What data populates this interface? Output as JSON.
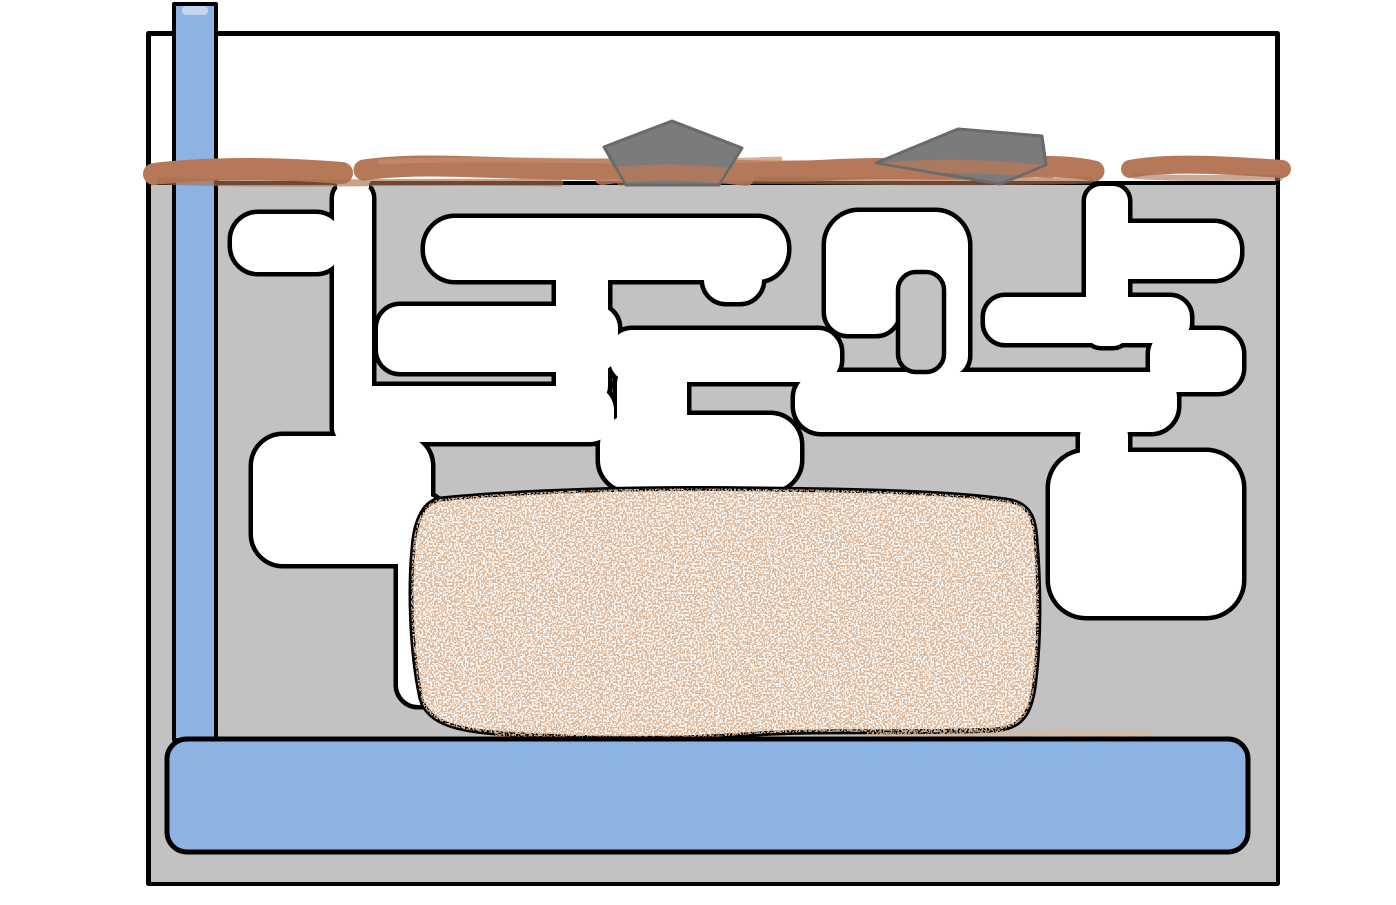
{
  "diagram": {
    "kind": "hand-drawn formicarium (ant farm) cross-section",
    "elements": {
      "container": "enclosure-tank",
      "substrate": "gray-substrate-fill",
      "tunnels": "white-ant-tunnel-network",
      "surface": "brown-soil-surface-layer",
      "surface_entrances": [
        "left-nest-entrance-gap",
        "right-nest-entrance-gap"
      ],
      "rocks": [
        "left-pentagon-rock",
        "right-flat-rock"
      ],
      "water_tube": "vertical-blue-water-tube",
      "water_reservoir": "bottom-blue-water-bar",
      "food_chamber": "speckled-sand-chamber"
    }
  },
  "colors": {
    "background": "#ffffff",
    "container_fill": "#ffffff",
    "outline": "#000000",
    "substrate": "#c2c2c2",
    "tunnel_fill": "#ffffff",
    "surface_soil": "#b5795a",
    "surface_soil_dark": "#a96e4f",
    "surface_soil_light": "#c48c6b",
    "speckle": "#b57a54",
    "rock_fill": "#7b7b7b",
    "rock_outline": "#6a6a6a",
    "water": "#8db3e2",
    "water_light": "#c3d5ef"
  }
}
